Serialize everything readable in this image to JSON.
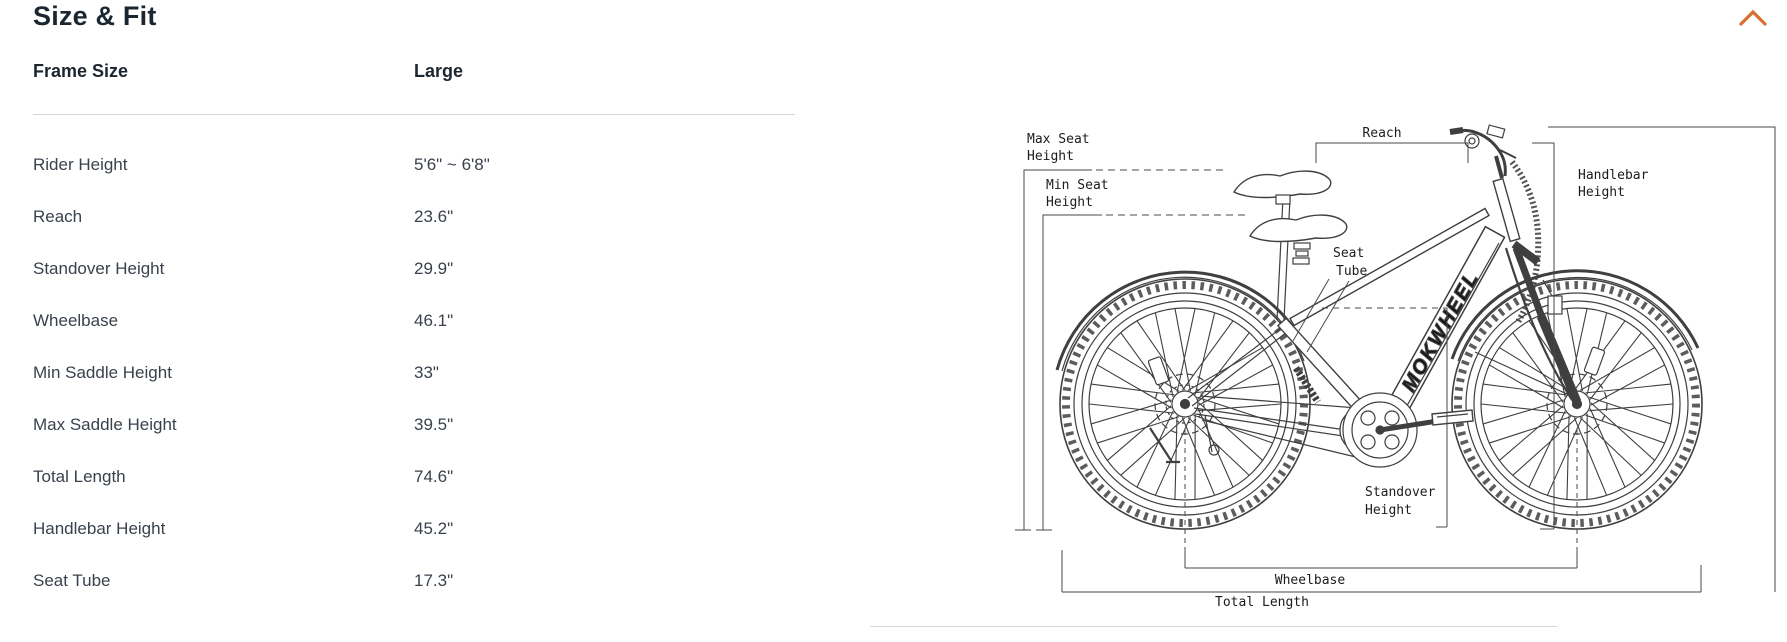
{
  "section": {
    "title": "Size & Fit"
  },
  "table": {
    "header": {
      "label": "Frame Size",
      "value": "Large"
    },
    "rows": [
      {
        "label": "Rider Height",
        "value": "5'6\" ~ 6'8\""
      },
      {
        "label": "Reach",
        "value": "23.6\""
      },
      {
        "label": "Standover Height",
        "value": "29.9\""
      },
      {
        "label": "Wheelbase",
        "value": "46.1\""
      },
      {
        "label": "Min Saddle Height",
        "value": "33\""
      },
      {
        "label": "Max Saddle Height",
        "value": "39.5\""
      },
      {
        "label": "Total Length",
        "value": "74.6\""
      },
      {
        "label": "Handlebar Height",
        "value": "45.2\""
      },
      {
        "label": "Seat Tube",
        "value": "17.3\""
      }
    ]
  },
  "diagram": {
    "brand": "MOKWHEEL",
    "labels": {
      "max_seat": [
        "Max Seat",
        "Height"
      ],
      "min_seat": [
        "Min Seat",
        "Height"
      ],
      "reach": "Reach",
      "handlebar": [
        "Handlebar",
        "Height"
      ],
      "seat_tube": [
        "Seat",
        "Tube"
      ],
      "standover": [
        "Standover",
        "Height"
      ],
      "wheelbase": "Wheelbase",
      "total_length": "Total Length"
    }
  },
  "colors": {
    "accent_orange": "#D96E2E",
    "line_gray": "#D6D6D6",
    "text_dark": "#1B2630",
    "diagram_ink": "#3F3F3F"
  }
}
